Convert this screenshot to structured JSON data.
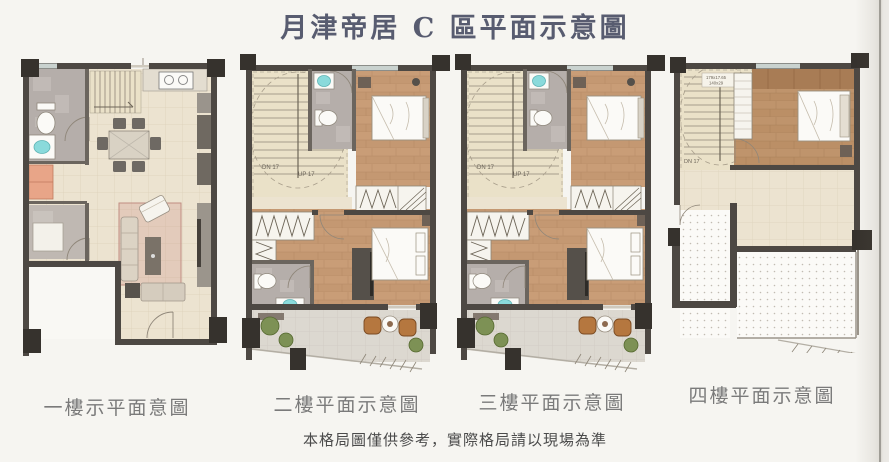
{
  "title": "月津帝居 C 區平面示意圖",
  "footnote": "本格局圖僅供參考，實際格局請以現場為準",
  "floors": [
    {
      "label": "一樓示平面意圖"
    },
    {
      "label": "二樓平面示意圖"
    },
    {
      "label": "三樓平面示意圖"
    },
    {
      "label": "四樓平面示意圖"
    }
  ],
  "stairs": {
    "down_label": "DN 17",
    "up_label": "UP 17",
    "dim_line1": "179x17.65",
    "dim_line2": "140x29"
  },
  "colors": {
    "wall": "#4d4843",
    "column": "#36322d",
    "wood_floor": "#c49872",
    "tile_floor": "#ece3d0",
    "bath_tile": "#b5aeaa",
    "basin_teal": "#8adadb",
    "cabinet_orange": "#e8a588",
    "plant_green": "#7d9155",
    "title_ink": "#585c70",
    "label_gray": "#7a7a7a"
  }
}
